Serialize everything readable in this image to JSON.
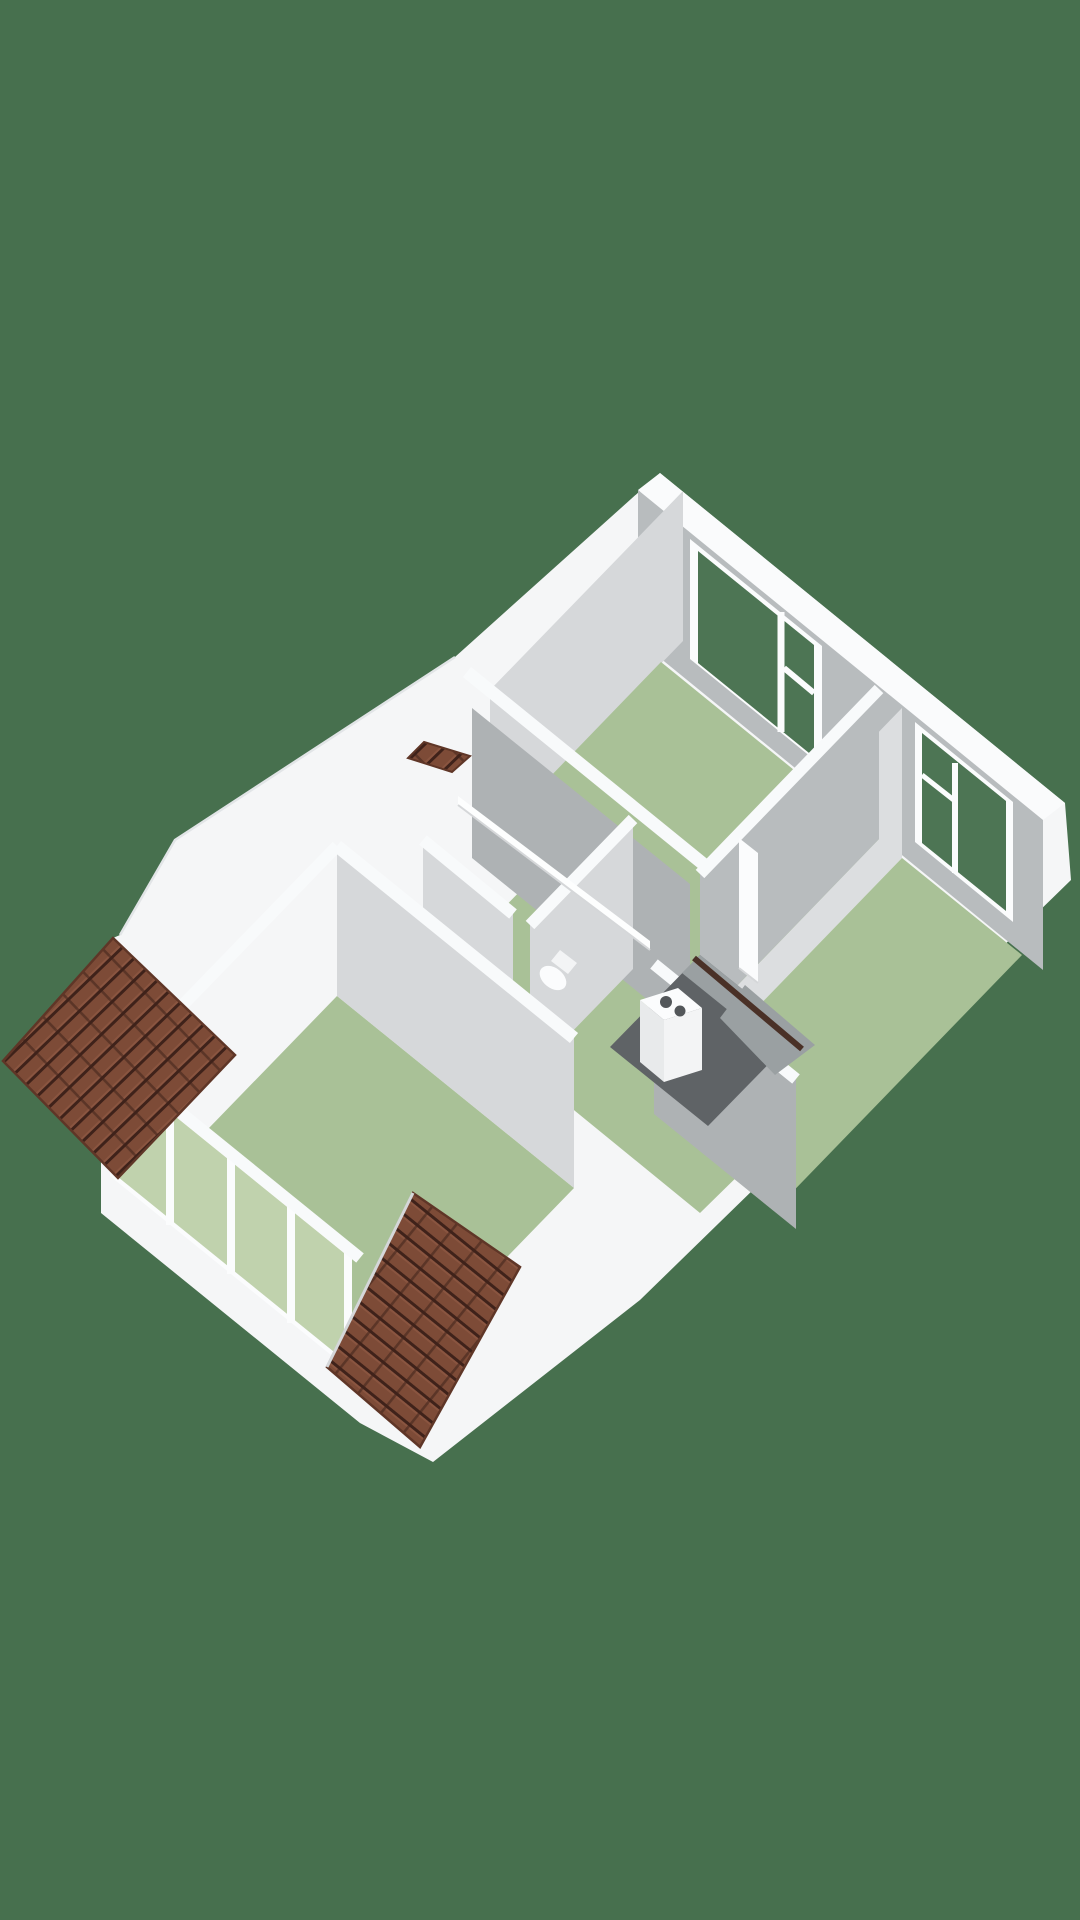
{
  "scene": {
    "kind": "isometric-3d-floorplan",
    "floor": "upper-floor",
    "text_content": "none"
  },
  "colors": {
    "bg": "#47704E",
    "shell_white": "#f5f6f7",
    "band_white": "#fafbfc",
    "band_stroke": "#f8fafb",
    "face_light": "#d6d8da",
    "face_lighter": "#dcdee0",
    "face_mid": "#aeb2b4",
    "face_mid2": "#b8bcbe",
    "face_dark": "#9aa0a2",
    "floor_green": "#a9c197",
    "glass_interior": "#c0d2ad",
    "glass_exterior": "#4d7554",
    "void_dark": "#5f6366",
    "rail_wood": "#4a3127",
    "white_rail": "#fdfefe",
    "tile_base": "#7d4b37",
    "tile_dark": "#3f221a",
    "tile_mid": "#8a5540",
    "tile_edge": "#5f3627",
    "crease": "#e2e5e7",
    "fixture_white": "#fbfcfd",
    "fixture_side": "#e8eaeb",
    "fixture_side2": "#f3f4f5",
    "fixture_detail": "#53575a",
    "fixture_stroke": "#d5d7d9"
  },
  "objects": {
    "rooms": [
      "bedroom-north",
      "bedroom-east",
      "living-room-southwest",
      "wc",
      "landing"
    ],
    "roofs": [
      "dormer-southwest",
      "dormer-south",
      "dormer-north-sliver"
    ],
    "fixtures": [
      "stair-void",
      "stair-handrail",
      "balustrade",
      "boiler",
      "toilet",
      "door-leaf"
    ],
    "windows": {
      "north_bedroom_panes": 2,
      "east_bedroom_panes": 2,
      "living_room_panes": 4
    }
  }
}
